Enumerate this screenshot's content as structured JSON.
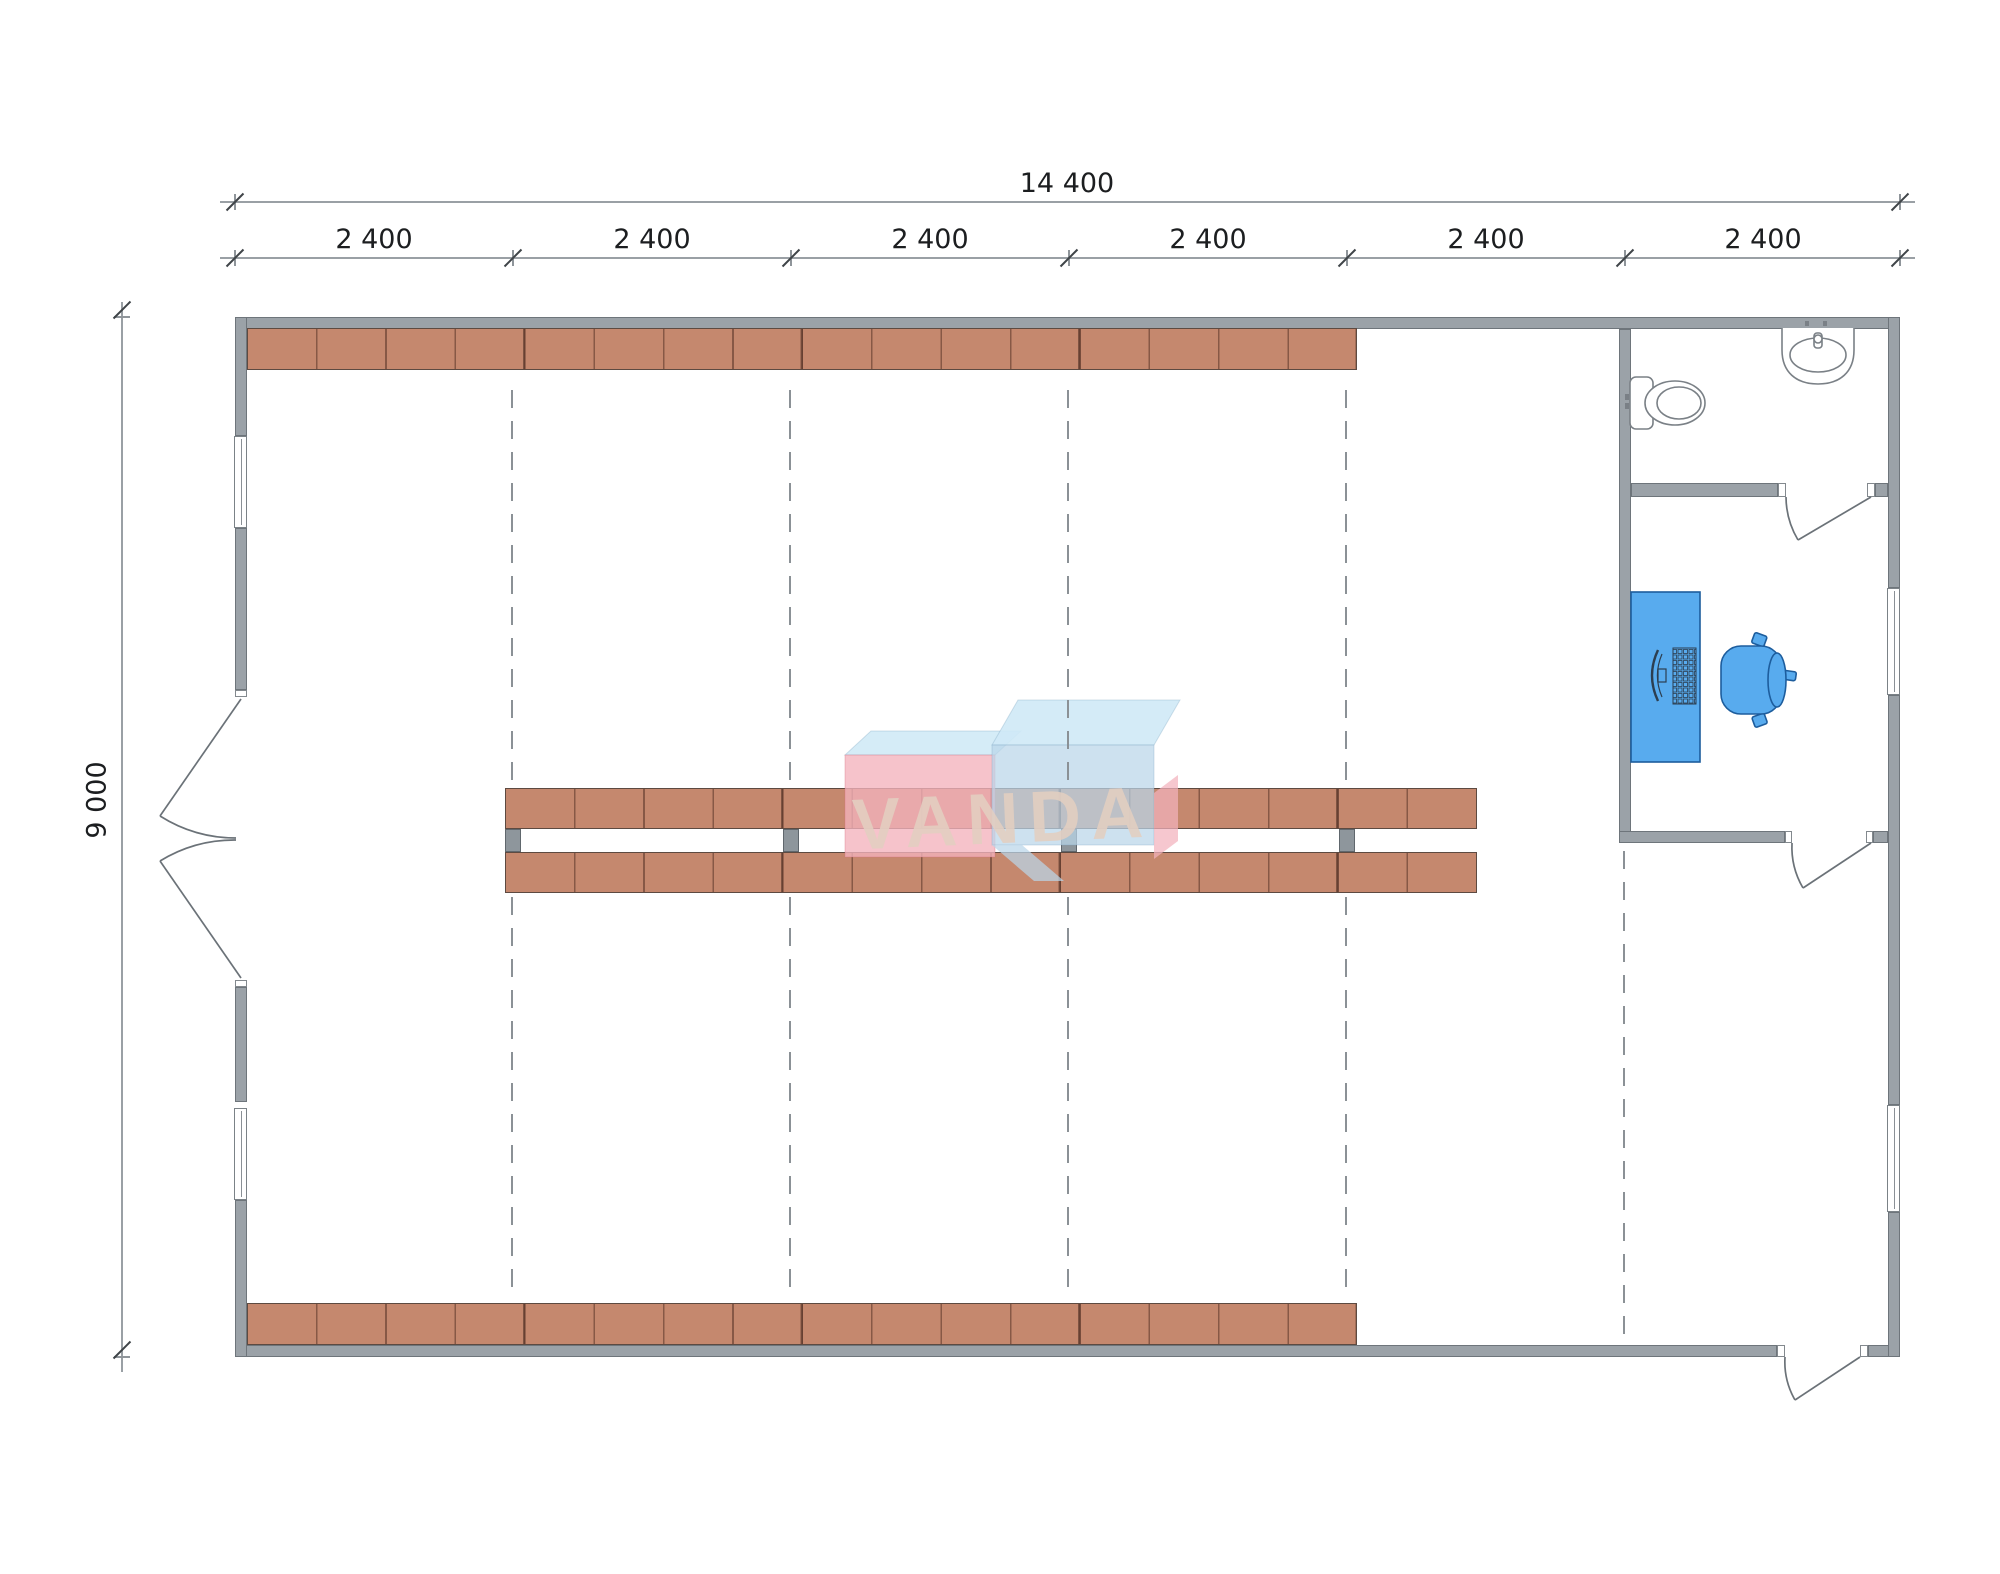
{
  "drawing": {
    "type": "architectural-floor-plan",
    "building": "single-hall warehouse with corner bathroom and office"
  },
  "dims": {
    "total_width": "14 400",
    "total_height": "9 000",
    "bays": [
      {
        "label": "2 400"
      },
      {
        "label": "2 400"
      },
      {
        "label": "2 400"
      },
      {
        "label": "2 400"
      },
      {
        "label": "2 400"
      },
      {
        "label": "2 400"
      }
    ]
  },
  "watermark": {
    "text": "VANDA",
    "pink_box_color": "#f3b2bc",
    "blue_box_color": "#bad6e9",
    "top_face_color": "#cfe9f6"
  },
  "colors": {
    "wall": "#9ba2a8",
    "wall_outline": "#6e757b",
    "shelf": "#c5886e",
    "shelf_divider": "#6b4b3c",
    "furniture_fill": "#58abee",
    "furniture_stroke": "#1d5d9d",
    "dimension_line": "#9aa0a5",
    "grid_dash": "#8b9196",
    "fixture_stroke": "#7a8086"
  },
  "fixtures": {
    "bathroom": [
      "toilet",
      "sink"
    ],
    "office": [
      "desk",
      "monitor",
      "keyboard",
      "office-chair"
    ],
    "doors": [
      "double-entry-door",
      "bathroom-door",
      "office-door",
      "rear-exit-door"
    ],
    "windows": 4
  }
}
